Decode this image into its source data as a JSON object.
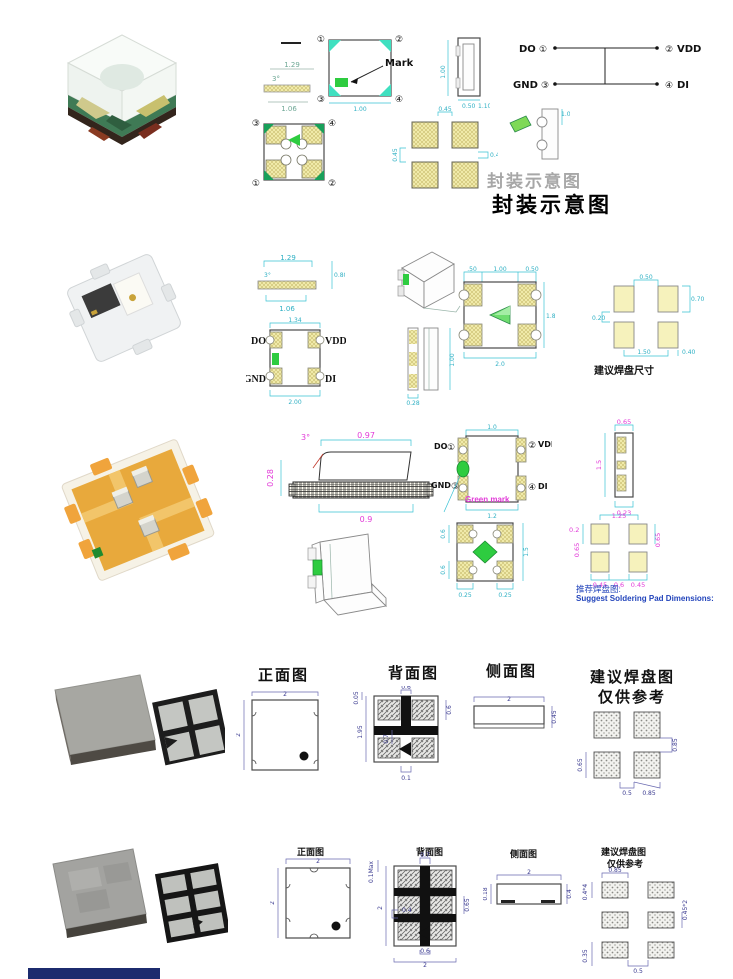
{
  "colors": {
    "dim_cyan": "#2fb0c4",
    "dim_magenta": "#e23ad8",
    "dim_blue": "#39398f",
    "mark_green": "#2ecc40",
    "pad_yellow": "#f3eeae",
    "corner_teal": "#3fe0c0",
    "caption_blue": "#2244bb",
    "strip_navy": "#1c2b6e"
  },
  "captions": {
    "pkg_schematic": "封装示意图",
    "pkg_schematic_ghost": "封装示意图",
    "r2_pad": "建议焊盘尺寸",
    "r3_pad_cn": "推荐焊盘图:",
    "r3_pad_en": "Suggest Soldering Pad Dimensions:",
    "front_view": "正面图",
    "back_view": "背面图",
    "side_view": "侧面图",
    "pad_view": "建议焊盘图",
    "ref_only": "仅供参考"
  },
  "pins": {
    "do": "DO",
    "gnd": "GND",
    "vdd": "VDD",
    "di": "DI",
    "n1": "①",
    "n2": "②",
    "n3": "③",
    "n4": "④",
    "mark": "Mark",
    "green_mark": "Green mark"
  },
  "r1": {
    "s129": "1.29",
    "s3deg": "3°",
    "s106": "1.06",
    "w100": "1.00",
    "h100": "1.00",
    "b050": "0.50",
    "b110": "1.10",
    "p045t": "0.45",
    "p045l": "0.45",
    "p04r": "0.4",
    "p10": "1.0"
  },
  "r2": {
    "s129": "1.29",
    "s3deg": "3°",
    "s106": "1.06",
    "s080": "0.80",
    "w134": "1.34",
    "w200": "2.00",
    "h100": "1.00",
    "b028": "0.28",
    "t050a": ".50",
    "t100": "1.00",
    "t050b": "0.50",
    "r18": "1.8",
    "b20": "2.0",
    "p050": "0.50",
    "p020": "0.20",
    "p070": "0.70",
    "p150": "1.50",
    "p040": "0.40"
  },
  "r3": {
    "deg": "3°",
    "t097": "0.97",
    "l028": "0.28",
    "b09": "0.9",
    "t10": "1.0",
    "b12": "1.2",
    "sv065": "0.65",
    "sv15": "1.5",
    "sv023": "0.23",
    "bl06a": "0.6",
    "bl06b": "0.6",
    "br15": "1.5",
    "bb025a": "0.25",
    "bb025b": "0.25",
    "p125": "1.25",
    "p02": "0.2",
    "p065l": "0.65",
    "p065r": "0.65",
    "p045a": "0.45",
    "p06": "0.6",
    "p045b": "0.45"
  },
  "r4": {
    "f2t": "2",
    "f2l": "2",
    "bk005": "0.05",
    "bk06t": "0.6",
    "bk195": "1.95",
    "bk07": "0.7",
    "bk01": "0.1",
    "bk06r": "0.6",
    "sd2": "2",
    "sd045": "0.45",
    "pd065": "0.65",
    "pd05": "0.5",
    "pd085b": "0.85",
    "pd085r": "0.85"
  },
  "r5": {
    "f2t": "2",
    "f2l": "2",
    "bk01max": "0.1Max",
    "bk07": "0.7",
    "bk2l": "2",
    "bk04": "0.4",
    "bk06": "0.6",
    "bk2b": "2",
    "bk065": "0.65",
    "sd2": "2",
    "sd018": "0.18",
    "sd04": "0.4",
    "pd044": "0.4*4",
    "pd085": "0.85",
    "pd0452": "0.45*2",
    "pd035": "0.35",
    "pd05": "0.5"
  }
}
